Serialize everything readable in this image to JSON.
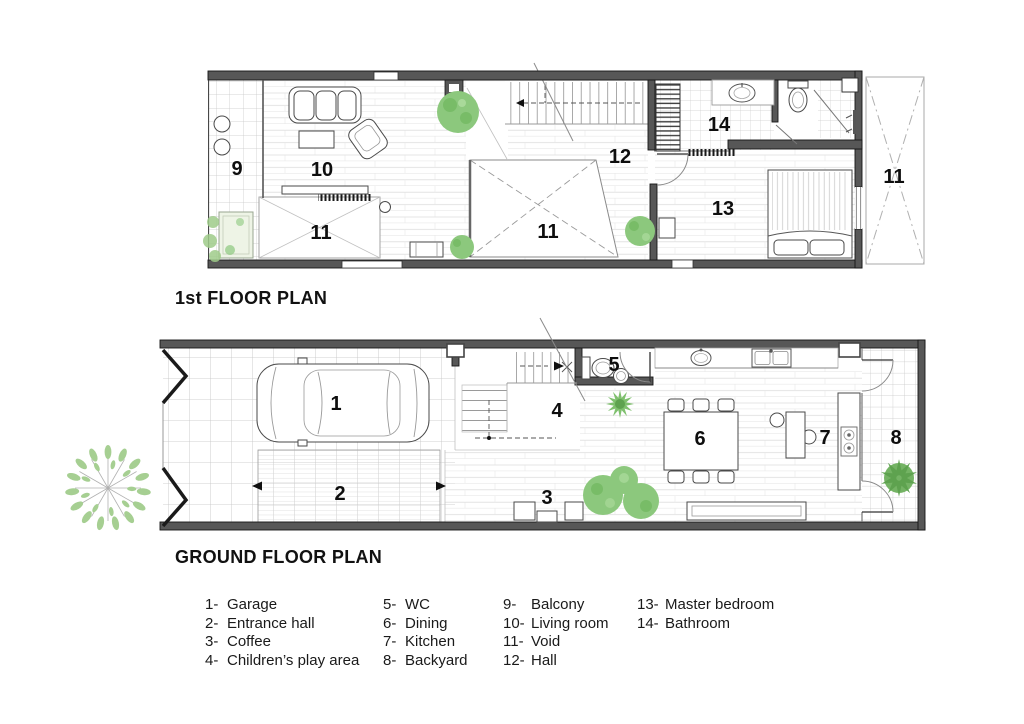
{
  "floor1_plan": {
    "title": "1st FLOOR PLAN",
    "room_labels": {
      "balcony": "9",
      "living_room": "10",
      "void_left": "11",
      "void_center": "11",
      "void_right": "11",
      "hall": "12",
      "master_bedroom": "13",
      "bathroom": "14"
    }
  },
  "ground_plan": {
    "title": "GROUND FLOOR PLAN",
    "room_labels": {
      "garage": "1",
      "entrance_hall": "2",
      "coffee": "3",
      "childrens_play_area": "4",
      "wc": "5",
      "dining": "6",
      "kitchen": "7",
      "backyard": "8"
    }
  },
  "legend": {
    "columns": [
      {
        "items": [
          {
            "num": "1-",
            "label": "Garage"
          },
          {
            "num": "2-",
            "label": "Entrance hall"
          },
          {
            "num": "3-",
            "label": "Coffee"
          },
          {
            "num": "4-",
            "label": "Children’s play area"
          }
        ]
      },
      {
        "items": [
          {
            "num": "5-",
            "label": "WC"
          },
          {
            "num": "6-",
            "label": "Dining"
          },
          {
            "num": "7-",
            "label": "Kitchen"
          },
          {
            "num": "8-",
            "label": "Backyard"
          }
        ]
      },
      {
        "items": [
          {
            "num": "9-",
            "label": "Balcony"
          },
          {
            "num": "10-",
            "label": "Living room"
          },
          {
            "num": "11-",
            "label": "Void"
          },
          {
            "num": "12-",
            "label": "Hall"
          }
        ]
      },
      {
        "items": [
          {
            "num": "13-",
            "label": "Master bedroom"
          },
          {
            "num": "14-",
            "label": "Bathroom"
          }
        ]
      }
    ]
  },
  "colors": {
    "wall": "#575757",
    "green": "#8cc87d",
    "green_dark": "#6fb05d",
    "text": "#111111"
  }
}
